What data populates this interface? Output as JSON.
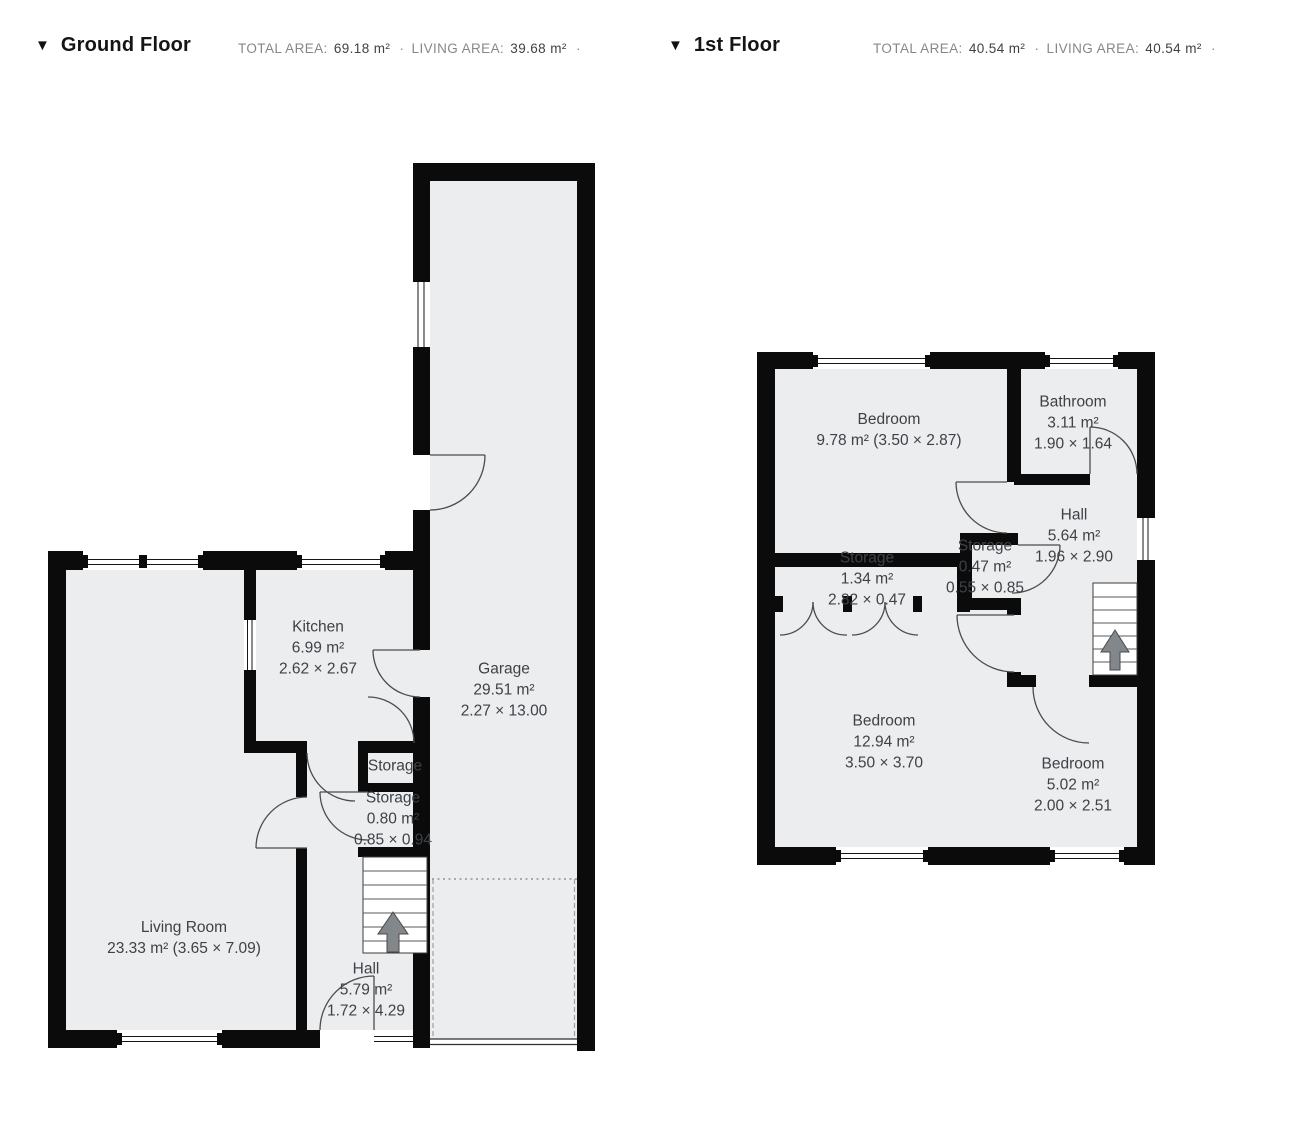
{
  "colors": {
    "wall": "#0b0b0b",
    "floor_fill": "#ebedef",
    "label_text": "#3e4247",
    "door_arc": "#4c4c4c",
    "stair_arrow": "#82878c",
    "garage_dash": "#9aa0a6"
  },
  "headers": {
    "ground": {
      "marker": "▼",
      "title": "Ground Floor",
      "total_area_label": "TOTAL AREA:",
      "total_area_value": "69.18 m²",
      "separator": "·",
      "living_area_label": "LIVING AREA:",
      "living_area_value": "39.68 m²",
      "trailing_separator": "·"
    },
    "first": {
      "marker": "▼",
      "title": "1st Floor",
      "total_area_label": "TOTAL AREA:",
      "total_area_value": "40.54 m²",
      "separator": "·",
      "living_area_label": "LIVING AREA:",
      "living_area_value": "40.54 m²",
      "trailing_separator": "·"
    }
  },
  "ground_rooms": {
    "kitchen": {
      "name": "Kitchen",
      "area": "6.99 m²",
      "dims": "2.62 × 2.67"
    },
    "garage": {
      "name": "Garage",
      "area": "29.51 m²",
      "dims": "2.27 × 13.00"
    },
    "storage_upper": {
      "name": "Storage"
    },
    "storage_lower": {
      "name": "Storage",
      "area": "0.80 m²",
      "dims": "0.85 × 0.94"
    },
    "living_room": {
      "name": "Living Room",
      "area_dims": "23.33 m² (3.65 × 7.09)"
    },
    "hall": {
      "name": "Hall",
      "area": "5.79 m²",
      "dims": "1.72 × 4.29"
    }
  },
  "first_rooms": {
    "bedroom_top": {
      "name": "Bedroom",
      "area_dims": "9.78 m² (3.50 × 2.87)"
    },
    "bathroom": {
      "name": "Bathroom",
      "area": "3.11 m²",
      "dims": "1.90 × 1.64"
    },
    "hall": {
      "name": "Hall",
      "area": "5.64 m²",
      "dims": "1.96 × 2.90"
    },
    "storage_wide": {
      "name": "Storage",
      "area": "1.34 m²",
      "dims": "2.82 × 0.47"
    },
    "storage_small": {
      "name": "Storage",
      "area": "0.47 m²",
      "dims": "0.55 × 0.85"
    },
    "bedroom_left": {
      "name": "Bedroom",
      "area": "12.94 m²",
      "dims": "3.50 × 3.70"
    },
    "bedroom_right": {
      "name": "Bedroom",
      "area": "5.02 m²",
      "dims": "2.00 × 2.51"
    }
  }
}
